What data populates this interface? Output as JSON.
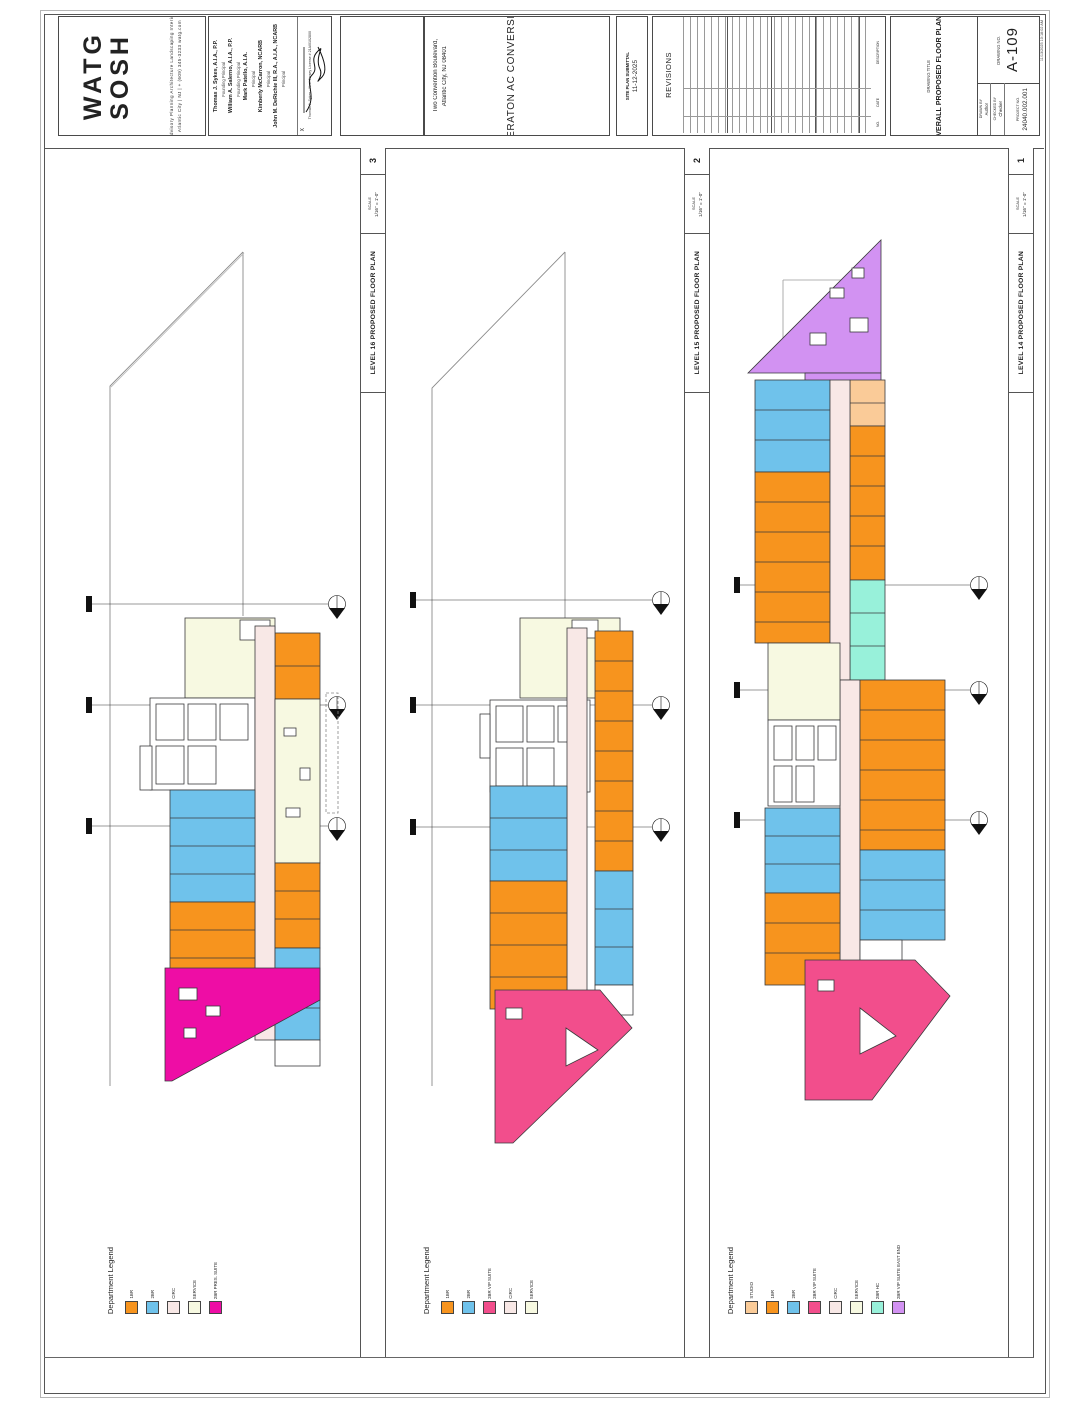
{
  "palette": {
    "1br": "#F7941E",
    "2br": "#6FC2EB",
    "circ": "#F8E8E6",
    "service": "#F7F9E1",
    "pres": "#EE0DA5",
    "vip": "#F24E8C",
    "studio": "#FACB98",
    "hc": "#98F1DA",
    "east": "#D292F2"
  },
  "sheet": {
    "logo_line1": "WATG",
    "logo_line2": "SOSH",
    "tagline1": "Advisory  Planning  Architecture  Landscaping  Interior",
    "tagline2": "Atlantic City | NJ | + (609) 345-3233        watg.com",
    "principals": [
      {
        "name": "Thomas J. Sykes, A.I.A., P.P.",
        "title": "Founding Principal"
      },
      {
        "name": "William A. Salerno, A.I.A., P.P.",
        "title": "Founding Principal"
      },
      {
        "name": "Mark Patello, A.I.A.",
        "title": "Principal"
      },
      {
        "name": "Kimberly McCarron, NCARB",
        "title": "Principal"
      },
      {
        "name": "John M. DeRichie III, R.A., A.I.A., NCARB",
        "title": "Principal"
      }
    ],
    "signature_x": "X",
    "signature_caption": "Thomas J. Sykes · New Jersey License # 21AI0102800",
    "project_address1": "Two Convention Boulevard,",
    "project_address2": "Atlantic City, NJ 08401",
    "project_name": "SHERATON AC CONVERSION",
    "submittal_label": "SITE PLAN SUBMITTAL",
    "submittal_date": "11-12-2025",
    "revisions_title": "REVISIONS",
    "revisions_cols": [
      "DESCRIPTION",
      "DATE",
      "NO."
    ],
    "titleblock": {
      "drawing_title_label": "DRAWING TITLE",
      "drawing_title": "OVERALL PROPOSED FLOOR PLANS",
      "drawing_no_label": "DRAWING NO.",
      "drawing_no": "A-109",
      "drawn_by_label": "DRAWN BY",
      "drawn_by": "Author",
      "checked_by_label": "CHECKED BY",
      "checked_by": "Checker",
      "project_no_label": "PROJECT NO.",
      "project_no": "24040.002.001",
      "plot_stamp": "11/13/2025 10:18:02 AM"
    }
  },
  "viewports": [
    {
      "number": "3",
      "scale_label": "SCALE",
      "scale": "1/16\" = 1'-0\"",
      "title": "LEVEL 16 PROPOSED FLOOR PLAN",
      "legend": {
        "title": "Department Legend",
        "items": [
          {
            "label": "1BR",
            "color": "#F7941E"
          },
          {
            "label": "2BR",
            "color": "#6FC2EB"
          },
          {
            "label": "CIRC",
            "color": "#F8E8E6"
          },
          {
            "label": "SERVICE",
            "color": "#F7F9E1"
          },
          {
            "label": "2BR PRES. SUITE",
            "color": "#EE0DA5"
          }
        ]
      }
    },
    {
      "number": "2",
      "scale_label": "SCALE",
      "scale": "1/16\" = 1'-0\"",
      "title": "LEVEL 15 PROPOSED FLOOR PLAN",
      "legend": {
        "title": "Department Legend",
        "items": [
          {
            "label": "1BR",
            "color": "#F7941E"
          },
          {
            "label": "2BR",
            "color": "#6FC2EB"
          },
          {
            "label": "2BR VIP SUITE",
            "color": "#F24E8C"
          },
          {
            "label": "CIRC",
            "color": "#F8E8E6"
          },
          {
            "label": "SERVICE",
            "color": "#F7F9E1"
          }
        ]
      }
    },
    {
      "number": "1",
      "scale_label": "SCALE",
      "scale": "1/16\" = 1'-0\"",
      "title": "LEVEL 14 PROPOSED FLOOR PLAN",
      "legend": {
        "title": "Department Legend",
        "items": [
          {
            "label": "STUDIO",
            "color": "#FACB98"
          },
          {
            "label": "1BR",
            "color": "#F7941E"
          },
          {
            "label": "2BR",
            "color": "#6FC2EB"
          },
          {
            "label": "2BR VIP SUITE",
            "color": "#F24E8C"
          },
          {
            "label": "CIRC",
            "color": "#F8E8E6"
          },
          {
            "label": "SERVICE",
            "color": "#F7F9E1"
          },
          {
            "label": "2BR HC",
            "color": "#98F1DA"
          },
          {
            "label": "2BR VIP SUITE EAST END",
            "color": "#D292F2"
          }
        ]
      }
    }
  ]
}
